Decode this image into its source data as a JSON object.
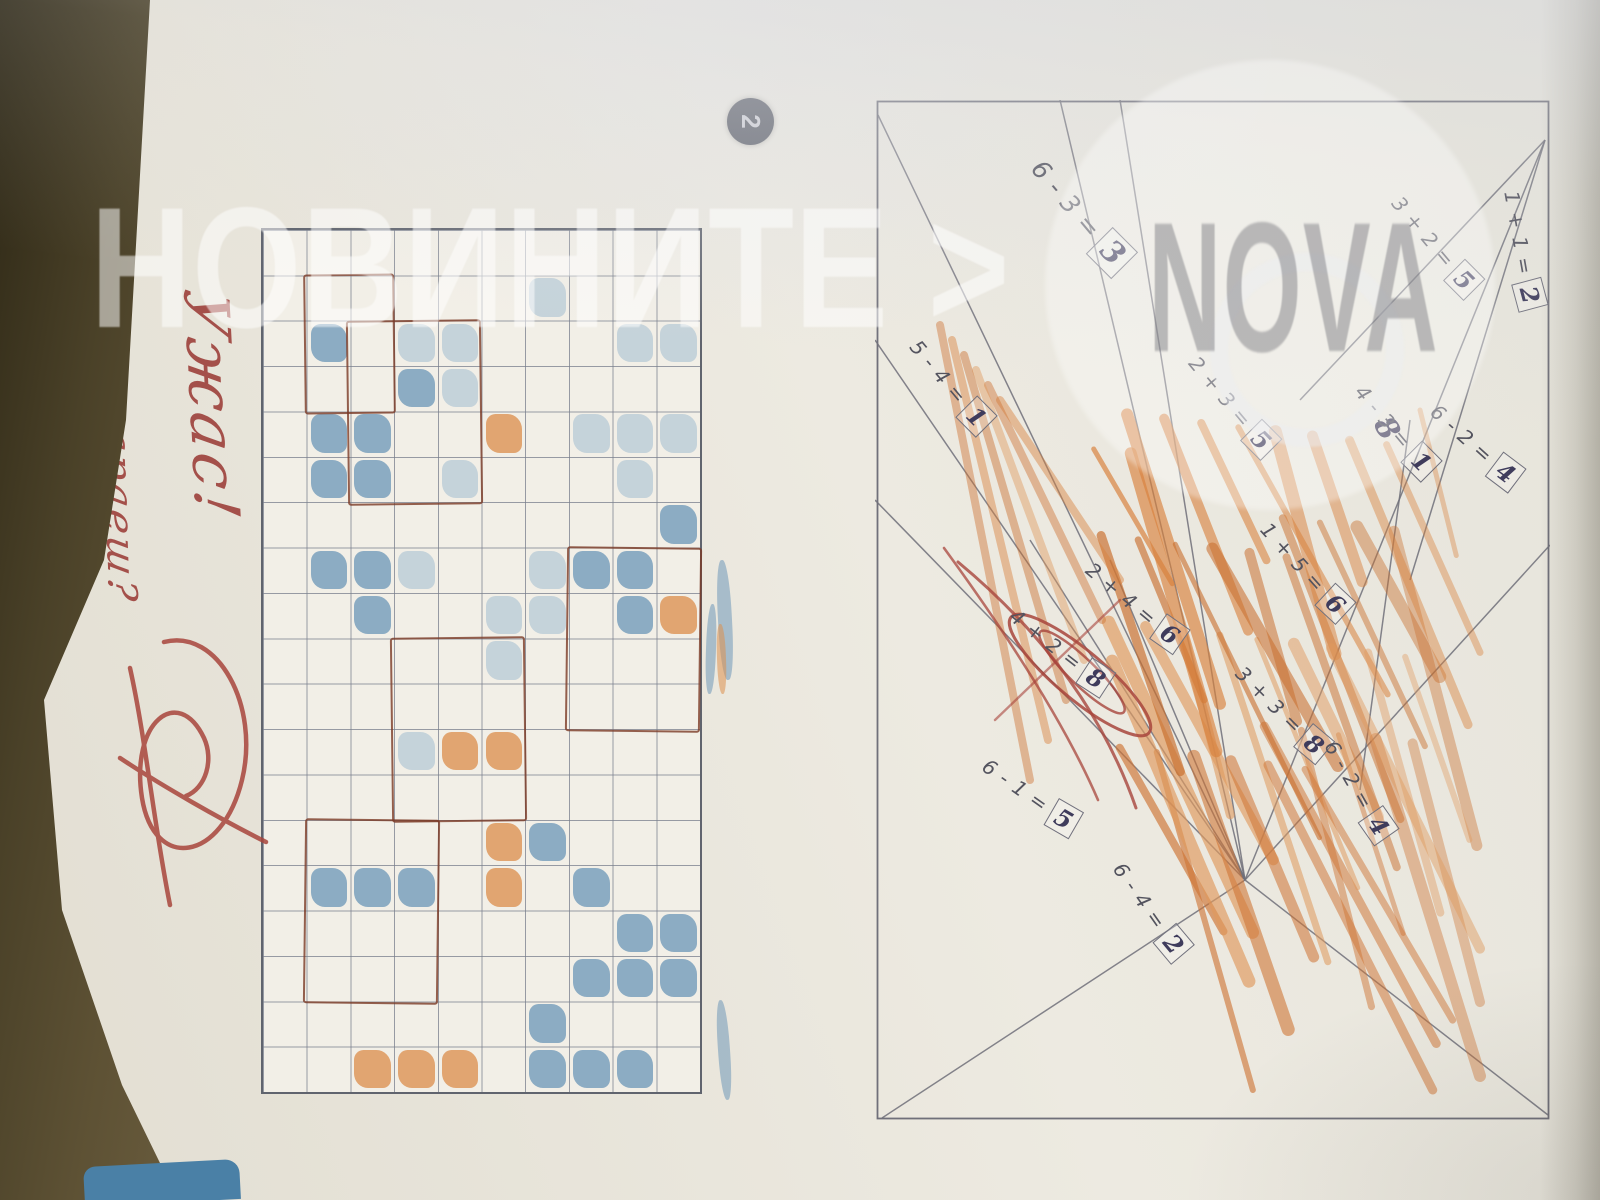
{
  "watermark": {
    "masthead": "НОВИНИТЕ >",
    "logo": "NOVA"
  },
  "exercise_badge": "2",
  "teacher_note": {
    "line1": "Ужас!",
    "line2": "Защо не се стараеш?",
    "ink_color": "#a4504a"
  },
  "puzzle": {
    "description_equations": [
      {
        "expr": "1 + 1 =",
        "ans": "2",
        "x": 150,
        "y": 28,
        "r": -10
      },
      {
        "expr": "3 + 2 =",
        "ans": "5",
        "x": 145,
        "y": 115,
        "r": -40
      },
      {
        "expr": "4 - 3 =",
        "ans": "1",
        "x": 330,
        "y": 155,
        "r": -40
      },
      {
        "expr": "6 - 2 =",
        "ans": "4",
        "x": 345,
        "y": 75,
        "r": -48
      },
      {
        "expr": "6 - 3 =",
        "ans": "3",
        "x": 115,
        "y": 470,
        "r": -40,
        "big": true
      },
      {
        "expr": "2 + 3 =",
        "ans": "5",
        "x": 305,
        "y": 318,
        "r": -40
      },
      {
        "expr": "5 - 4 =",
        "ans": "1",
        "x": 285,
        "y": 600,
        "r": -40
      },
      {
        "expr": "1 + 5 =",
        "ans": "6",
        "x": 470,
        "y": 245,
        "r": -42
      },
      {
        "expr": "3 + 3 =",
        "ans": "8",
        "x": 612,
        "y": 268,
        "r": -45
      },
      {
        "expr": "2 + 4 =",
        "ans": "6",
        "x": 505,
        "y": 415,
        "r": -50
      },
      {
        "expr": "4 + 2 =",
        "ans": "8",
        "x": 550,
        "y": 490,
        "r": -52,
        "red_circled": true
      },
      {
        "expr": "6 - 1 =",
        "ans": "5",
        "x": 695,
        "y": 520,
        "r": -55
      },
      {
        "expr": "6 - 2 =",
        "ans": "4",
        "x": 690,
        "y": 192,
        "r": -30
      },
      {
        "expr": "6 - 4 =",
        "ans": "2",
        "x": 810,
        "y": 400,
        "r": -35
      }
    ],
    "stray_answer": "8",
    "segments": [
      [
        15,
        672,
        780,
        305
      ],
      [
        40,
        5,
        780,
        305
      ],
      [
        1015,
        2,
        780,
        305
      ],
      [
        1018,
        668,
        780,
        305
      ],
      [
        0,
        490,
        780,
        305
      ],
      [
        40,
        5,
        300,
        250
      ],
      [
        40,
        5,
        480,
        140
      ],
      [
        780,
        305,
        445,
        0
      ],
      [
        780,
        305,
        460,
        440
      ],
      [
        780,
        305,
        440,
        520
      ],
      [
        780,
        305,
        400,
        675
      ],
      [
        780,
        305,
        0,
        430
      ],
      [
        780,
        305,
        240,
        675
      ],
      [
        320,
        140,
        690,
        190
      ]
    ],
    "line_color": "#70707a",
    "crayon_colors": [
      "#d9813c",
      "#cf7434",
      "#e09a5e",
      "#c96f2e"
    ],
    "red_pen_color": "#a8453c",
    "ink_color": "#3f3c5c",
    "print_color": "#53535e"
  },
  "grid": {
    "rows": [
      "..l.l.b.o......bb..",
      "..l.ll.bb......bb.b",
      "....l..b......b.b.b",
      ".l.....ll....b...bb",
      "....o...ll.o.oo....",
      "..ll.l.....o......o",
      "..lb...l...l..b...o",
      "....bb.bb.....b...o",
      "..b.bb.b......b....",
      "..................."
    ],
    "cell_colors": {
      "b": "#6f98b8",
      "l": "#a7bfd2",
      "o": "#dc8f4f"
    },
    "pencil_outlines": [
      [
        2,
        5,
        4,
        3
      ],
      [
        7,
        0,
        4,
        3
      ],
      [
        9,
        4,
        4,
        3
      ],
      [
        13,
        6,
        4,
        3
      ],
      [
        1,
        7,
        3,
        2
      ]
    ],
    "outline_color": "#7a3a26"
  },
  "photo": {
    "table_color": "#4a4128",
    "bookmark_color": "#4a80a6",
    "page_color": "#e9e6de"
  }
}
